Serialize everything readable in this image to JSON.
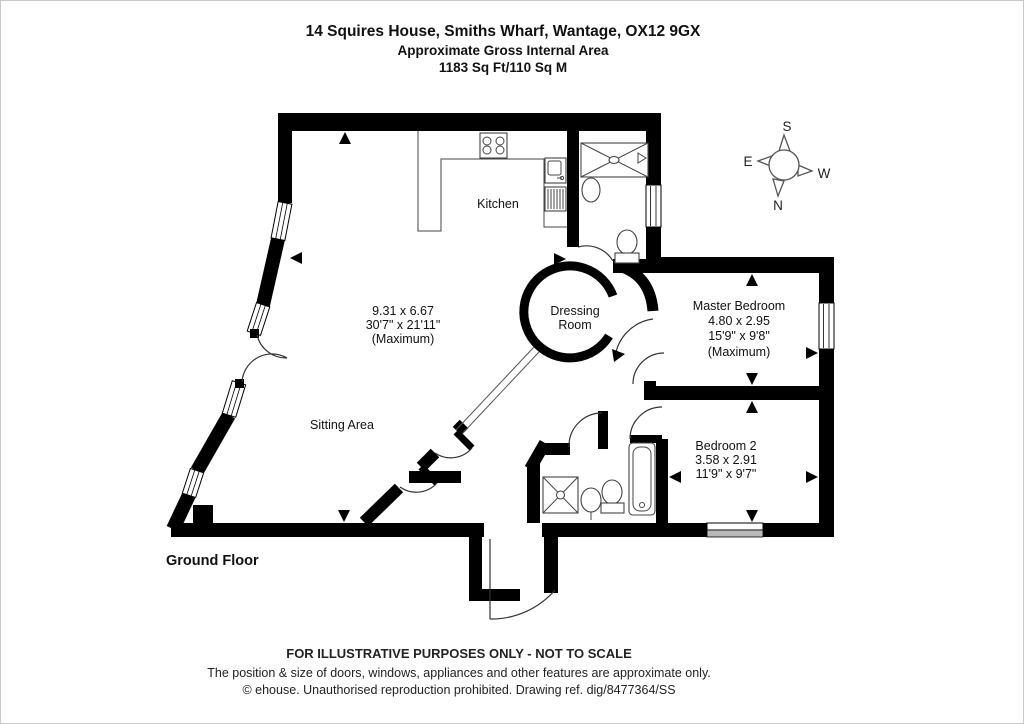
{
  "title": {
    "line1": "14 Squires House, Smiths Wharf, Wantage, OX12 9GX",
    "line2": "Approximate Gross Internal Area",
    "line3": "1183 Sq Ft/110 Sq M"
  },
  "floor_label": "Ground Floor",
  "compass": {
    "north": "N",
    "south": "S",
    "east": "E",
    "west": "W"
  },
  "rooms": {
    "kitchen": {
      "name": "Kitchen"
    },
    "sitting": {
      "name": "Sitting Area",
      "dims_m": "9.31 x 6.67",
      "dims_ft": "30'7\" x 21'11\"",
      "note": "(Maximum)"
    },
    "dressing": {
      "name_line1": "Dressing",
      "name_line2": "Room"
    },
    "master": {
      "name": "Master Bedroom",
      "dims_m": "4.80 x 2.95",
      "dims_ft": "15'9\" x 9'8\"",
      "note": "(Maximum)"
    },
    "bedroom2": {
      "name": "Bedroom 2",
      "dims_m": "3.58 x 2.91",
      "dims_ft": "11'9\" x 9'7\""
    }
  },
  "footer": {
    "line1": "FOR ILLUSTRATIVE PURPOSES ONLY - NOT TO SCALE",
    "line2": "The position & size of doors, windows, appliances and other features are approximate only.",
    "line3": "© ehouse. Unauthorised reproduction prohibited. Drawing ref. dig/8477364/SS"
  },
  "colors": {
    "wall": "#000000",
    "background": "#ffffff",
    "frame": "#c8c8c8"
  }
}
